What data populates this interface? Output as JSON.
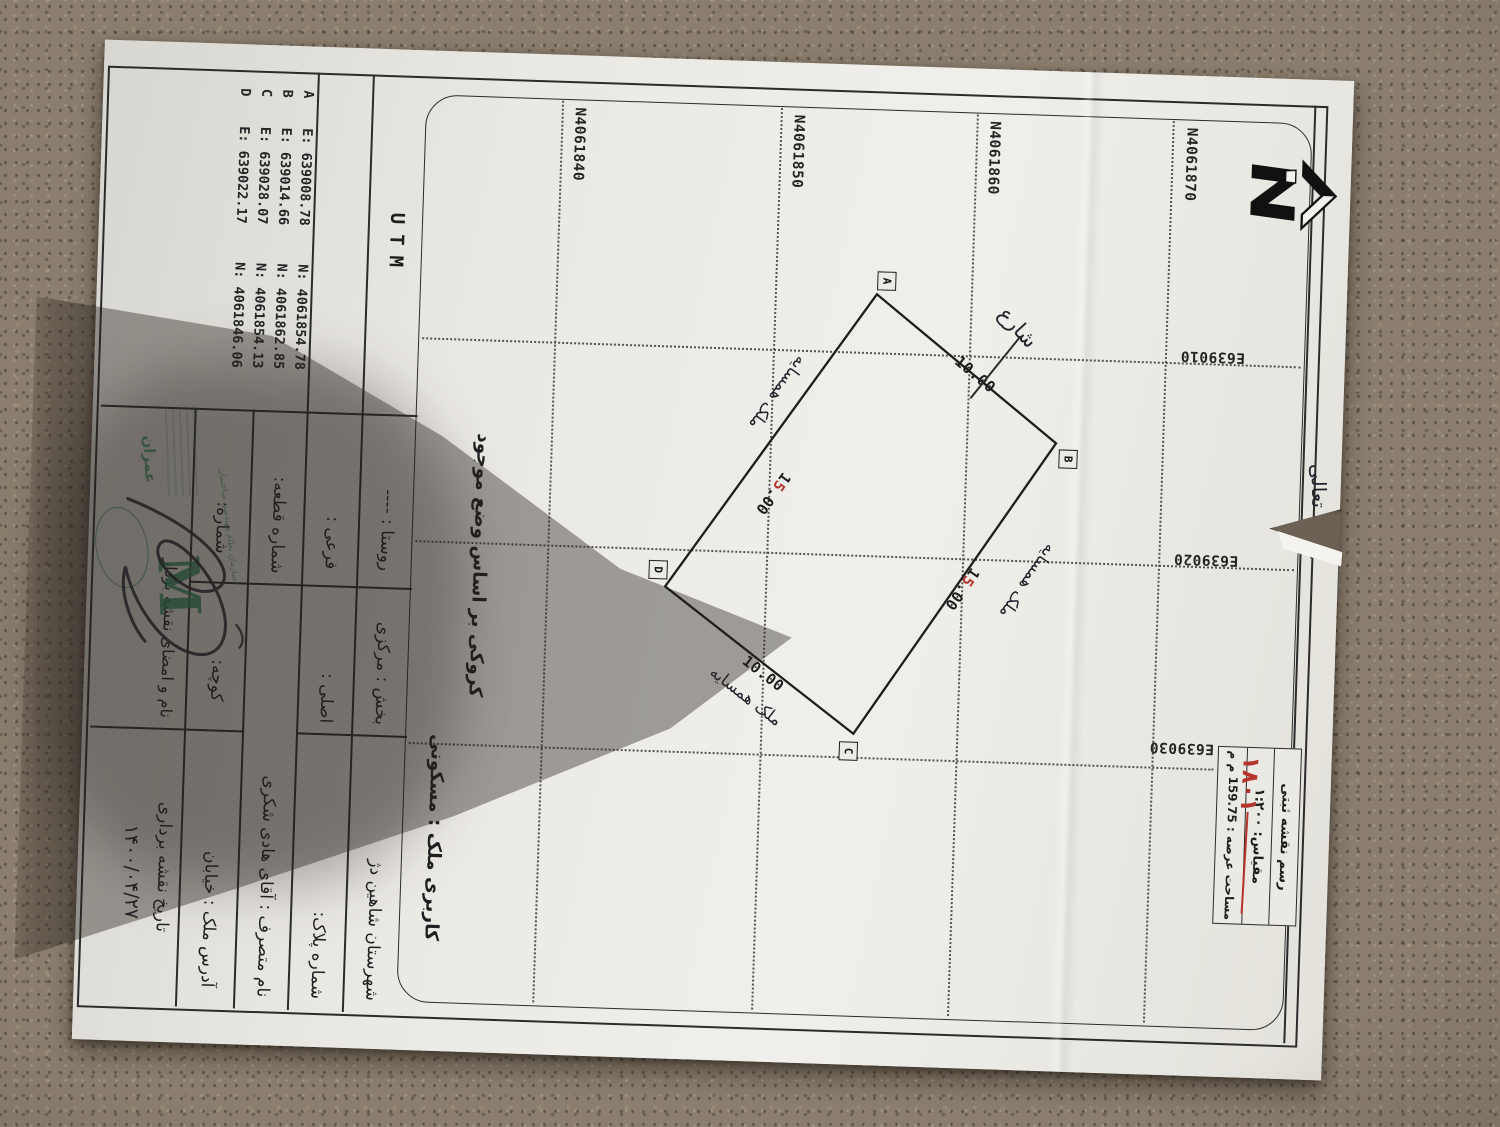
{
  "document": {
    "bismillah": "بسمه تعالی",
    "title_block": {
      "title": "رسم نقشه ثبتی",
      "scale": "مقیاس: ۱:۲۰۰",
      "area": "مساحت عرصه : 159.75 م م"
    },
    "red_note": "۱۸۰۱",
    "grid": {
      "n_labels": [
        "N4061870",
        "N4061860",
        "N4061850",
        "N4061840"
      ],
      "e_labels": [
        "E639010",
        "E639020",
        "E639030"
      ]
    },
    "plot": {
      "corners": [
        "A",
        "B",
        "C",
        "D"
      ],
      "dim_ab": "10.00",
      "dim_cd": "10.00",
      "dim15_black": "1",
      "dim15_red": "5",
      "dim15_tail": ".00",
      "street_label": "شارع",
      "neighbor_label": "ملک همسایه"
    },
    "sketch_note": "کروکی بر اساس وضع موجود",
    "usage": "کاربری ملک : مسکونی",
    "form": {
      "city": "شهرستان شاهین دژ",
      "district": "بخش : مرکزی",
      "village": "روستا : ----",
      "utm_header": "UTM",
      "plate_no": "شماره پلاک:",
      "main_no": "اصلی :",
      "sub_no": "فرعی :",
      "occupant": "نام متصرف : آقای هادی شکری",
      "parcel_no": "شماره قطعه:",
      "address": "آدرس ملک : خیابان",
      "alley": "کوچه:",
      "number": "شماره:",
      "date_label": "تاریخ نقشه برداری",
      "date_value": "۱۴۰۰/۰۴/۲۷",
      "sign_label": "نام و امضای نقشه بردار"
    },
    "utm_table": {
      "points": [
        {
          "id": "A",
          "e": "E: 639008.78",
          "n": "N: 4061854.78"
        },
        {
          "id": "B",
          "e": "E: 639014.66",
          "n": "N: 4061862.85"
        },
        {
          "id": "C",
          "e": "E: 639028.07",
          "n": "N: 4061854.13"
        },
        {
          "id": "D",
          "e": "E: 639022.17",
          "n": "N: 4061846.06"
        }
      ]
    },
    "stamp": {
      "monogram": "M",
      "org": "عمران",
      "arc_text": "سازمان نظام مهندسی ساختمان"
    }
  }
}
